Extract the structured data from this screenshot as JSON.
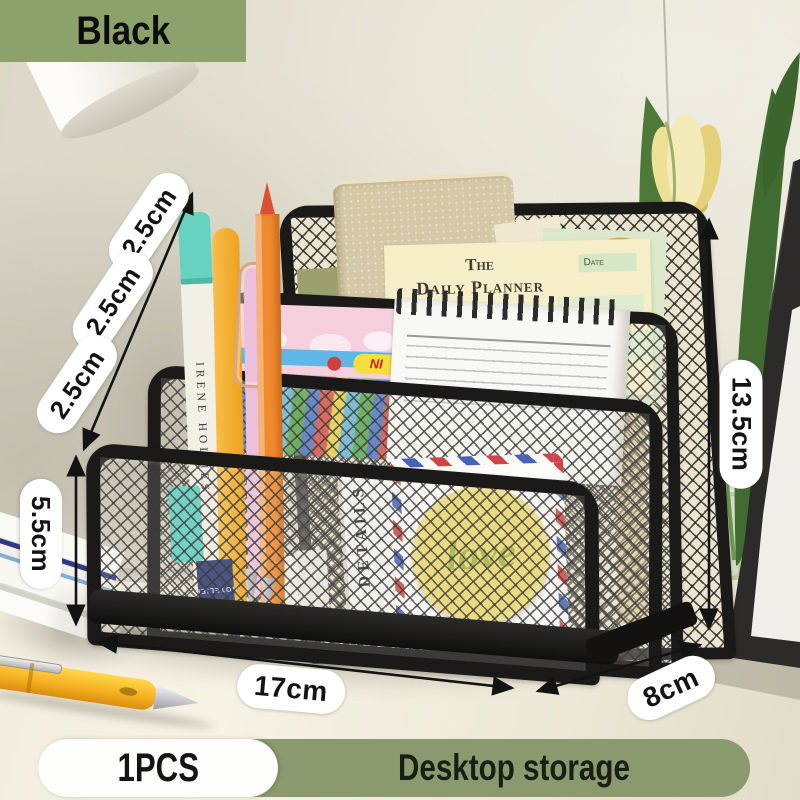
{
  "badge": {
    "label": "Black"
  },
  "annotations": {
    "slot_widths": [
      "2.5cm",
      "2.5cm",
      "2.5cm"
    ],
    "front_height": "5.5cm",
    "back_height": "13.5cm",
    "width": "17cm",
    "depth": "8cm"
  },
  "footer": {
    "quantity": "1PCS",
    "title": "Desktop storage"
  },
  "scene": {
    "planner": {
      "word_the": "The",
      "title": "Daily Planner",
      "date_label": "Date"
    },
    "marker_text": "IRENE HOLMES",
    "envelope_text": "DETAILS",
    "love_text": "love",
    "sticker_text": "NI",
    "card_text": "HOTELIER"
  },
  "colors": {
    "badge_bg": "#8da26a",
    "footer_bg": "#8b9a6e",
    "organizer_black": "#1b1a18",
    "love_yellow": "#e9d76f"
  }
}
